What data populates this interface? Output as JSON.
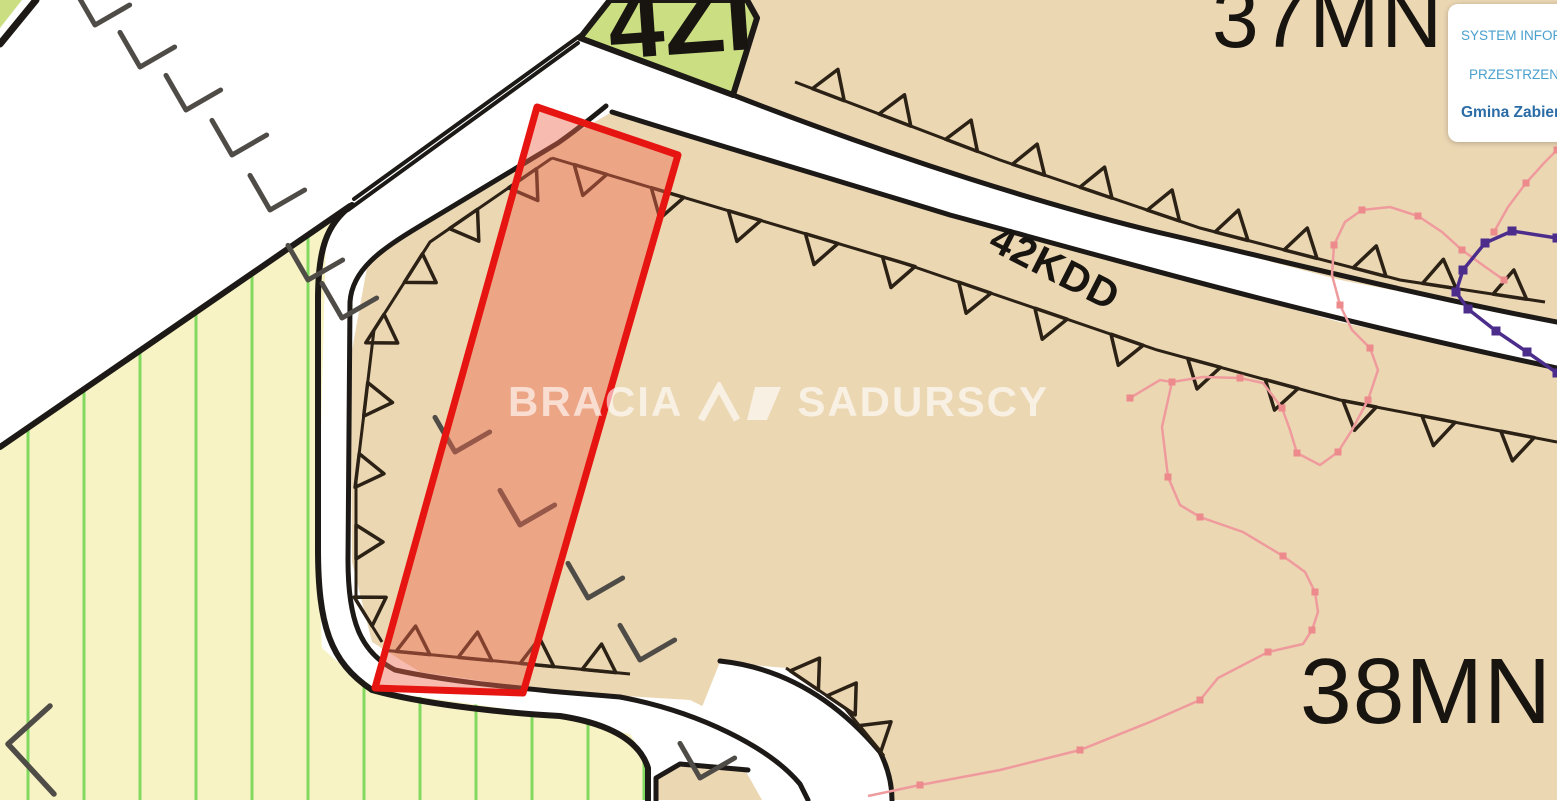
{
  "canvas": {
    "width": 1557,
    "height": 801
  },
  "colors": {
    "tan": "#ecd7b3",
    "green_zone": "#cbdf82",
    "yellow_zone": "#f7f3c4",
    "stripe_green": "#82d95f",
    "line_black": "#1c1916",
    "triangle_dark": "#2b2115",
    "dash_gray": "#4f4b46",
    "pink_line": "#ef9b9d",
    "pink_dot": "#ec8a8c",
    "purple_line": "#4c2d8c",
    "red_stroke": "#e61511",
    "red_fill": "rgba(238,105,78,0.45)",
    "white": "#ffffff"
  },
  "labels": {
    "zone_top": "4ZI",
    "zone_topright": "37MN",
    "zone_main": "38MN",
    "road": "42KDD"
  },
  "watermark": {
    "part1": "BRACIA",
    "part2": "SADURSCY"
  },
  "info_panel": {
    "line1": "SYSTEM INFORM",
    "line2": "PRZESTRZENN",
    "line3": "Gmina Zabierz"
  },
  "map": {
    "zones": [
      {
        "name": "corner-green-sliver",
        "points": "0,0 22,0 0,28",
        "fill": "green_zone"
      },
      {
        "name": "zone-37mn",
        "points": "747,0 1557,0 1557,322 1340,280 1157,232 950,175 733,95 757,18",
        "fill": "tan"
      },
      {
        "name": "zone-38mn",
        "points": "612,112 700,140 950,215 1157,272 1340,322 1557,368 1557,800 808,800 800,780 770,745 700,712 620,697 520,688 395,672 352,640 348,560 352,350 368,262 420,228 560,142",
        "fill": "tan"
      },
      {
        "name": "zone-yellow",
        "points": "350,206 326,240 318,550 322,648 370,690 560,716 630,734 650,765 650,800 0,800 0,447",
        "fill": "yellow_zone",
        "pattern": true
      },
      {
        "name": "road-main-corridor",
        "points": "583,36 356,203 326,240 318,550 322,648 370,690 560,716 630,734 650,765 650,800 760,800 755,762 735,722 690,700 560,692 420,672 372,642 352,562 350,302 362,257 420,226 560,140 606,106",
        "fill": "white"
      },
      {
        "name": "road-42kdd",
        "points": "733,95 950,175 1157,232 1340,280 1557,322 1557,368 1340,322 1157,272 950,215 700,140 612,112",
        "fill": "white"
      },
      {
        "name": "road-branch",
        "points": "700,712 770,745 800,782 808,800 893,800 880,752 838,702 786,668 720,662",
        "fill": "white"
      },
      {
        "name": "zone-4zi-wedge",
        "points": "580,38 610,0 747,0 757,18 733,95",
        "fill": "green_zone",
        "stroke": "line_black",
        "stroke_width": 6
      },
      {
        "name": "road-island",
        "points": "656,800 656,778 678,764 745,770 762,800",
        "fill": "tan"
      }
    ],
    "strokes": [
      {
        "name": "corridor-nw-edge-outer",
        "d": "M 585,32 L 354,199",
        "width": 4
      },
      {
        "name": "corridor-nw-edge-inner",
        "d": "M 578,43 L 348,210",
        "width": 4
      },
      {
        "name": "corridor-outer-edge",
        "d": "M 352,205 C 326,224 318,250 318,300 L 318,548 C 318,625 330,662 372,690 C 430,706 520,714 560,716 C 612,724 640,742 648,768 L 648,800",
        "width": 6
      },
      {
        "name": "corridor-inner-edge",
        "d": "M 606,106 C 584,124 568,136 558,143 L 420,226 C 380,250 352,270 350,302 L 348,560 C 348,620 360,652 395,670 C 450,682 520,688 560,692 L 620,697",
        "width": 5
      },
      {
        "name": "branch-outer-edge",
        "d": "M 620,697 C 700,712 770,748 800,784 L 808,800",
        "width": 5
      },
      {
        "name": "branch-inner-edge",
        "d": "M 720,661 C 786,668 838,702 880,752 C 888,768 892,784 892,800",
        "width": 5
      },
      {
        "name": "road42kdd-upper-edge",
        "d": "M 733,95 C 900,160 1050,206 1157,232 C 1270,258 1420,296 1557,322",
        "width": 5
      },
      {
        "name": "road42kdd-lower-edge",
        "d": "M 612,112 C 700,140 810,172 950,215 C 1080,250 1300,314 1557,368",
        "width": 5
      },
      {
        "name": "yellow-nw-boundary",
        "d": "M 350,206 L 0,447",
        "width": 6
      },
      {
        "name": "corner-boundary",
        "d": "M 0,44 L 36,0",
        "width": 7
      },
      {
        "name": "island-corner",
        "d": "M 656,800 L 656,778 L 680,764 L 748,770",
        "width": 5
      }
    ],
    "triangle_rows": [
      {
        "name": "setback-37mn",
        "points": [
          [
            795,
            82
          ],
          [
            1000,
            160
          ],
          [
            1200,
            228
          ],
          [
            1400,
            280
          ],
          [
            1545,
            302
          ]
        ],
        "count": 11,
        "side": -1,
        "draw_line": true
      },
      {
        "name": "setback-38mn-north",
        "points": [
          [
            552,
            158
          ],
          [
            900,
            262
          ],
          [
            1157,
            350
          ],
          [
            1340,
            400
          ],
          [
            1557,
            442
          ]
        ],
        "count": 13,
        "side": 1,
        "draw_line": true
      },
      {
        "name": "setback-38mn-west",
        "points": [
          [
            552,
            158
          ],
          [
            430,
            242
          ],
          [
            374,
            330
          ],
          [
            356,
            480
          ],
          [
            356,
            600
          ],
          [
            382,
            642
          ]
        ],
        "count": 8,
        "side": -1,
        "draw_line": true
      },
      {
        "name": "setback-38mn-south",
        "points": [
          [
            382,
            650
          ],
          [
            630,
            674
          ]
        ],
        "count": 4,
        "side": -1,
        "draw_line": true
      },
      {
        "name": "setback-branch",
        "points": [
          [
            786,
            668
          ],
          [
            845,
            708
          ],
          [
            884,
            756
          ]
        ],
        "count": 3,
        "side": -1,
        "draw_line": true
      }
    ],
    "dash_marks": {
      "arm": 40,
      "rotation": -30,
      "positions": [
        [
          95,
          25
        ],
        [
          140,
          67
        ],
        [
          186,
          110
        ],
        [
          232,
          155
        ],
        [
          270,
          210
        ],
        [
          308,
          280
        ],
        [
          342,
          318
        ],
        [
          455,
          452
        ],
        [
          520,
          525
        ],
        [
          588,
          598
        ],
        [
          640,
          660
        ],
        [
          700,
          778
        ]
      ]
    },
    "chevron_marks": [
      {
        "name": "boundary-chevron",
        "points": "50,706 8,744 54,794"
      }
    ],
    "pink_paths": [
      {
        "name": "pink-boundary-upper",
        "points": [
          [
            1130,
            398
          ],
          [
            1160,
            380
          ],
          [
            1172,
            382
          ],
          [
            1203,
            377
          ],
          [
            1240,
            378
          ],
          [
            1263,
            383
          ],
          [
            1282,
            408
          ],
          [
            1290,
            430
          ],
          [
            1297,
            453
          ],
          [
            1320,
            465
          ],
          [
            1338,
            452
          ],
          [
            1352,
            430
          ],
          [
            1368,
            400
          ],
          [
            1378,
            370
          ],
          [
            1370,
            348
          ],
          [
            1352,
            330
          ],
          [
            1340,
            305
          ],
          [
            1332,
            275
          ],
          [
            1334,
            245
          ],
          [
            1345,
            222
          ],
          [
            1362,
            210
          ],
          [
            1390,
            207
          ],
          [
            1418,
            216
          ],
          [
            1442,
            232
          ],
          [
            1462,
            250
          ],
          [
            1484,
            266
          ],
          [
            1504,
            280
          ]
        ]
      },
      {
        "name": "pink-boundary-lower",
        "points": [
          [
            1172,
            382
          ],
          [
            1162,
            427
          ],
          [
            1168,
            477
          ],
          [
            1180,
            505
          ],
          [
            1200,
            517
          ],
          [
            1243,
            532
          ],
          [
            1283,
            556
          ],
          [
            1305,
            572
          ],
          [
            1315,
            592
          ],
          [
            1318,
            612
          ],
          [
            1312,
            630
          ],
          [
            1303,
            644
          ],
          [
            1268,
            652
          ],
          [
            1218,
            678
          ],
          [
            1200,
            700
          ],
          [
            1150,
            722
          ],
          [
            1080,
            750
          ],
          [
            1000,
            770
          ],
          [
            920,
            785
          ],
          [
            868,
            796
          ]
        ]
      },
      {
        "name": "pink-boundary-corner",
        "points": [
          [
            1494,
            232
          ],
          [
            1508,
            207
          ],
          [
            1526,
            183
          ],
          [
            1544,
            163
          ],
          [
            1557,
            150
          ]
        ]
      }
    ],
    "purple_path": {
      "name": "purple-utility-line",
      "points": [
        [
          1557,
          238
        ],
        [
          1512,
          231
        ],
        [
          1485,
          243
        ],
        [
          1463,
          270
        ],
        [
          1456,
          292
        ],
        [
          1468,
          309
        ],
        [
          1496,
          331
        ],
        [
          1527,
          352
        ],
        [
          1557,
          373
        ]
      ]
    },
    "red_plot": {
      "points": "537,107 678,155 523,693 375,688"
    }
  }
}
